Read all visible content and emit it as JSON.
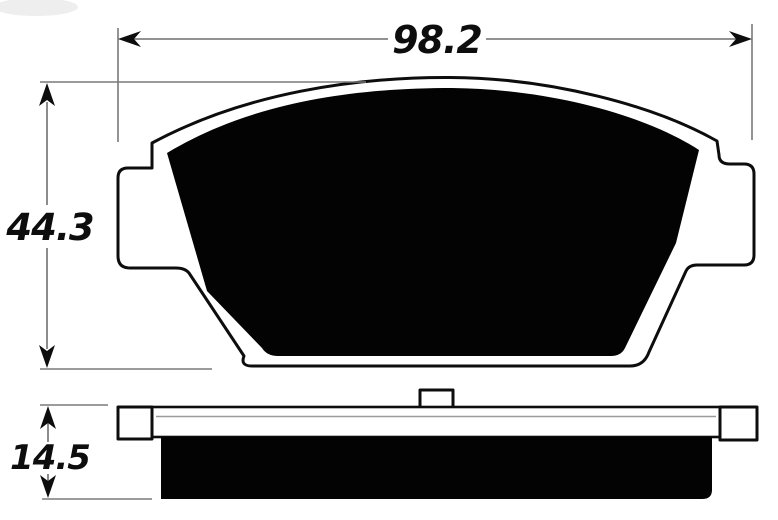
{
  "diagram": {
    "dimensions": {
      "width": {
        "value": "98.2"
      },
      "height": {
        "value": "44.3"
      },
      "thickness": {
        "value": "14.5"
      }
    },
    "colors": {
      "ink": "#0d0d0d",
      "fill": "#030303",
      "dim_line": "#6f6f6f",
      "background": "#ffffff"
    }
  }
}
